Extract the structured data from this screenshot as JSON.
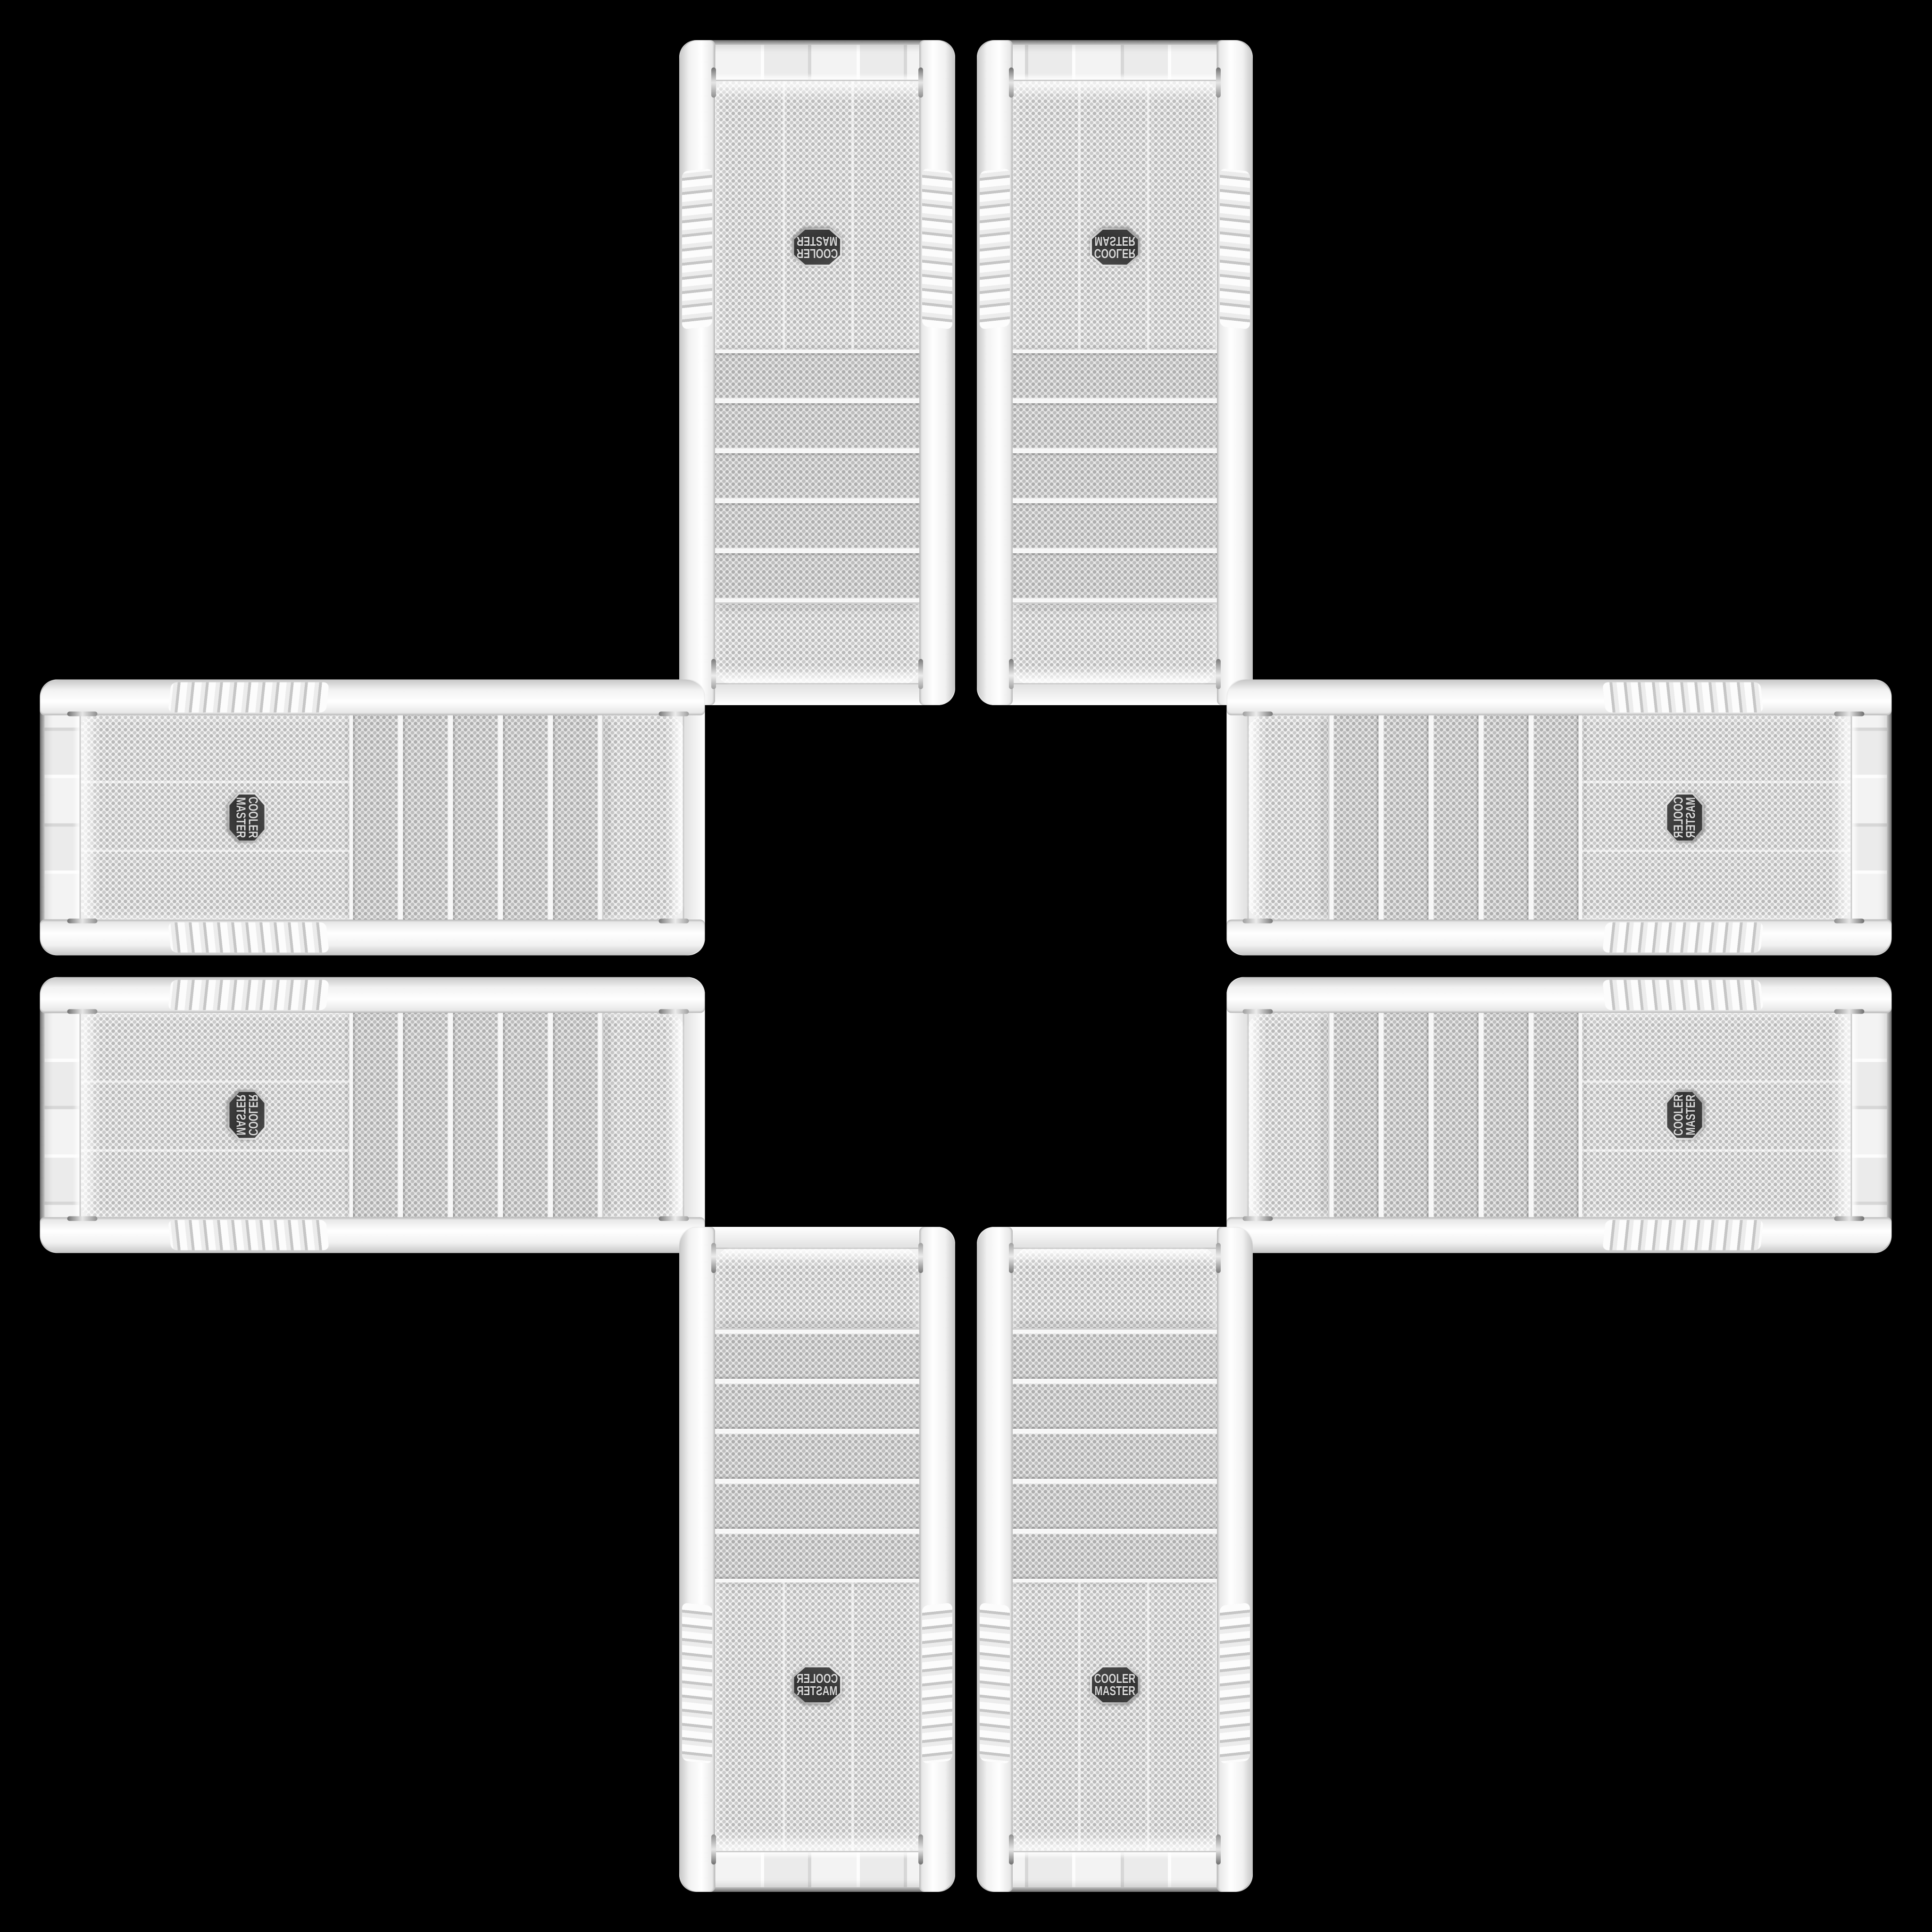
{
  "scene": {
    "description": "Eight identical white Cooler Master mid-tower PC cases arranged in a plus / cross pattern on a solid black background; each arm of the cross holds a mirrored pair so the mesh front panels and brand badges face outward",
    "background_color": "#000000",
    "object_count": 8
  },
  "badge": {
    "icon": "cooler-master-badge",
    "line1": "COOLER",
    "line2": "MASTER",
    "bg_color": "#3a3a3a",
    "text_color": "#d9d9d9",
    "rim_color": "#c9c9c9"
  },
  "case_colors": {
    "body": "#f3f3f3",
    "mesh_background": "#f3f3f3",
    "mesh_dots": "#b9b9b9",
    "drive_bay": "#e8e8e8",
    "rail_highlight": "#ffffff",
    "rail_shadow": "#c6c6c6",
    "chrome_trim": "#6d6d6d"
  },
  "cases": [
    {
      "id": "top-left",
      "orientation": "vertical",
      "badge_text_appearance": "rotated 180°"
    },
    {
      "id": "top-right",
      "orientation": "vertical",
      "badge_text_appearance": "flipped vertically"
    },
    {
      "id": "left-top",
      "orientation": "horizontal",
      "badge_text_appearance": "rotated 90° clockwise"
    },
    {
      "id": "left-bottom",
      "orientation": "horizontal",
      "badge_text_appearance": "rotated 90° and flipped"
    },
    {
      "id": "right-top",
      "orientation": "horizontal",
      "badge_text_appearance": "rotated 90° and mirrored"
    },
    {
      "id": "right-bottom",
      "orientation": "horizontal",
      "badge_text_appearance": "rotated 90° counter-clockwise"
    },
    {
      "id": "bottom-left",
      "orientation": "vertical",
      "badge_text_appearance": "mirrored horizontally"
    },
    {
      "id": "bottom-right",
      "orientation": "vertical",
      "badge_text_appearance": "upright"
    }
  ]
}
